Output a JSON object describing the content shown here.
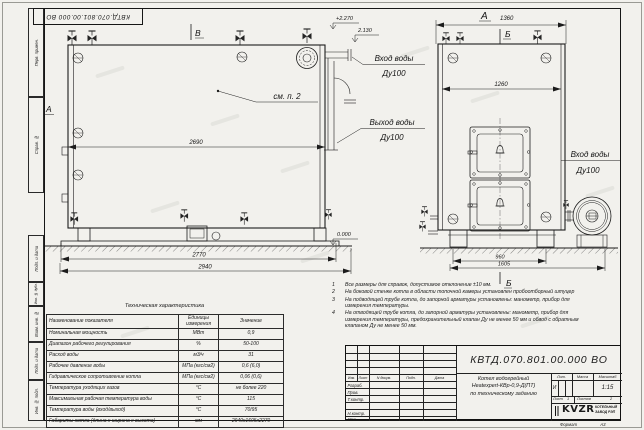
{
  "doc": {
    "number": "КВТД.070.801.00.000 ВО",
    "format_label": "Формат",
    "format_value": "А3"
  },
  "frame": {
    "left_labels": [
      "Перв. примен.",
      "Справ. №",
      "Подп. и дата",
      "Инв. № дубл.",
      "Взам. инв. №",
      "Подп. и дата",
      "Инв. № подл."
    ]
  },
  "side_view": {
    "mark_top": "В",
    "mark_left": "А",
    "ref_note": "см. п. 2",
    "dim_width": "2690",
    "dim_base": "2770",
    "dim_overall": "2940",
    "elev_inlet": "+2.270",
    "elev_outlet": "2.130",
    "elev_ground": "0.000",
    "inlet_title": "Вход воды",
    "inlet_dn": "Ду100",
    "outlet_title": "Выход воды",
    "outlet_dn": "Ду100"
  },
  "front_view": {
    "mark_top": "А",
    "dim_top": "1360",
    "section_top": "Б",
    "dim_inner": "1260",
    "inlet_title": "Вход воды",
    "inlet_dn": "Ду100",
    "dim_feet": "960",
    "dim_overall": "1605",
    "section_bottom": "Б"
  },
  "tech_table": {
    "title": "Техническая характеристика",
    "col_name": "Наименование показателя",
    "col_units": "Единицы измерения",
    "col_value": "Значение",
    "rows": [
      {
        "name": "Номинальная мощность",
        "units": "МВт",
        "value": "0,9"
      },
      {
        "name": "Диапазон рабочего регулирования",
        "units": "%",
        "value": "50-100"
      },
      {
        "name": "Расход воды",
        "units": "м3/ч",
        "value": "31"
      },
      {
        "name": "Рабочее давление воды",
        "units": "МПа (кгс/см2)",
        "value": "0,6 (6,0)"
      },
      {
        "name": "Гидравлическое сопротивление котла",
        "units": "МПа (кгс/см2)",
        "value": "0,06 (0,6)"
      },
      {
        "name": "Температура уходящих газов",
        "units": "°С",
        "value": "не более 220"
      },
      {
        "name": "Максимальная рабочая температура воды",
        "units": "°С",
        "value": "115"
      },
      {
        "name": "Температура воды (вход/выход)",
        "units": "°С",
        "value": "70/95"
      },
      {
        "name": "Габариты котла (длина х ширина х высота)",
        "units": "мм",
        "value": "2940х1605х2270"
      }
    ]
  },
  "notes": {
    "items": [
      {
        "num": "1",
        "text": "Все размеры для справок, допустимое отклонение ±10 мм."
      },
      {
        "num": "2",
        "text": "На боковой стенке котла в области топочной камеры установлен пробоотборный штуцер"
      },
      {
        "num": "3",
        "text": "На подводящей трубе котла, до запорной арматуры установлены: манометр, прибор для измерения температуры."
      },
      {
        "num": "4",
        "text": "На отводящей трубе котла, до запорной арматуры установлены: манометр, прибор для измерения температуры, предохранительный клапан Ду не менее 50 мм и обвод с обратным клапаном Ду не менее 50 мм."
      }
    ]
  },
  "title_block": {
    "doc_number": "КВТД.070.801.00.000 ВО",
    "cols": [
      "Изм.",
      "Лист",
      "N докум.",
      "Подп.",
      "Дата"
    ],
    "roles": [
      "Разраб.",
      "Пров.",
      "Т.контр.",
      "Н.контр.",
      "Утв."
    ],
    "product_line1": "Котел водогрейный",
    "product_line2": "Heatexpert-КВр-0,9-Д(ПТ)",
    "product_line3": "по техническому заданию",
    "lit_label": "Лит.",
    "lit_value": "И",
    "mass_label": "Масса",
    "scale_label": "Масштаб",
    "scale_value": "1:15",
    "sheet_label": "Лист",
    "sheet_value": "1",
    "sheets_label": "Листов",
    "sheets_value": "2",
    "logo_text": "KVZR",
    "org_line1": "КОТЕЛЬНЫЙ",
    "org_line2": "ЗАВОД РЭП"
  }
}
